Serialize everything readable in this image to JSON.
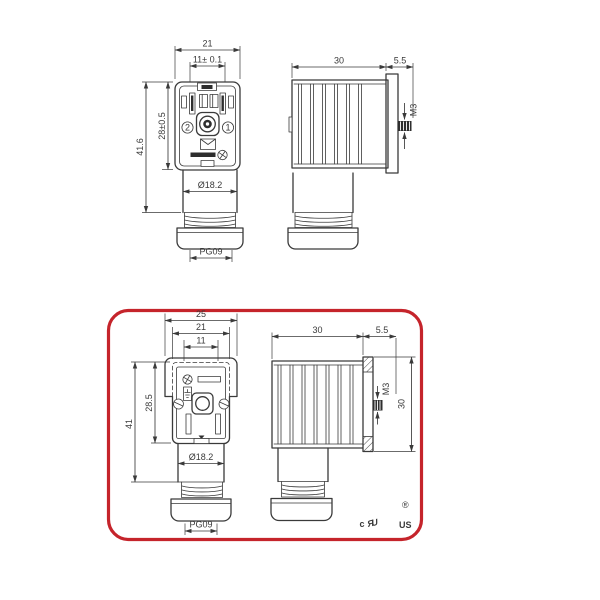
{
  "colors": {
    "line": "#3a3a3a",
    "accent_red": "#c5242b",
    "black": "#111111"
  },
  "top_front": {
    "w_outer": "21",
    "w_inner": "11± 0.1",
    "h_outer": "41.6",
    "h_inner": "28±0.5",
    "diameter": "Ø18.2",
    "gland": "PG09",
    "terminal_left": "2",
    "terminal_right": "1"
  },
  "top_side": {
    "depth": "30",
    "protrusion": "5.5",
    "thread": "M3"
  },
  "bottom_front": {
    "w_flange": "25",
    "w_outer": "21",
    "w_inner": "11",
    "h_outer": "41",
    "h_inner": "28.5",
    "diameter": "Ø18.2",
    "gland": "PG09"
  },
  "bottom_side": {
    "depth": "30",
    "protrusion": "5.5",
    "thread": "M3",
    "height": "30"
  },
  "certification": {
    "c": "c",
    "logo": "ЯU",
    "registered": "®",
    "us": "US"
  }
}
